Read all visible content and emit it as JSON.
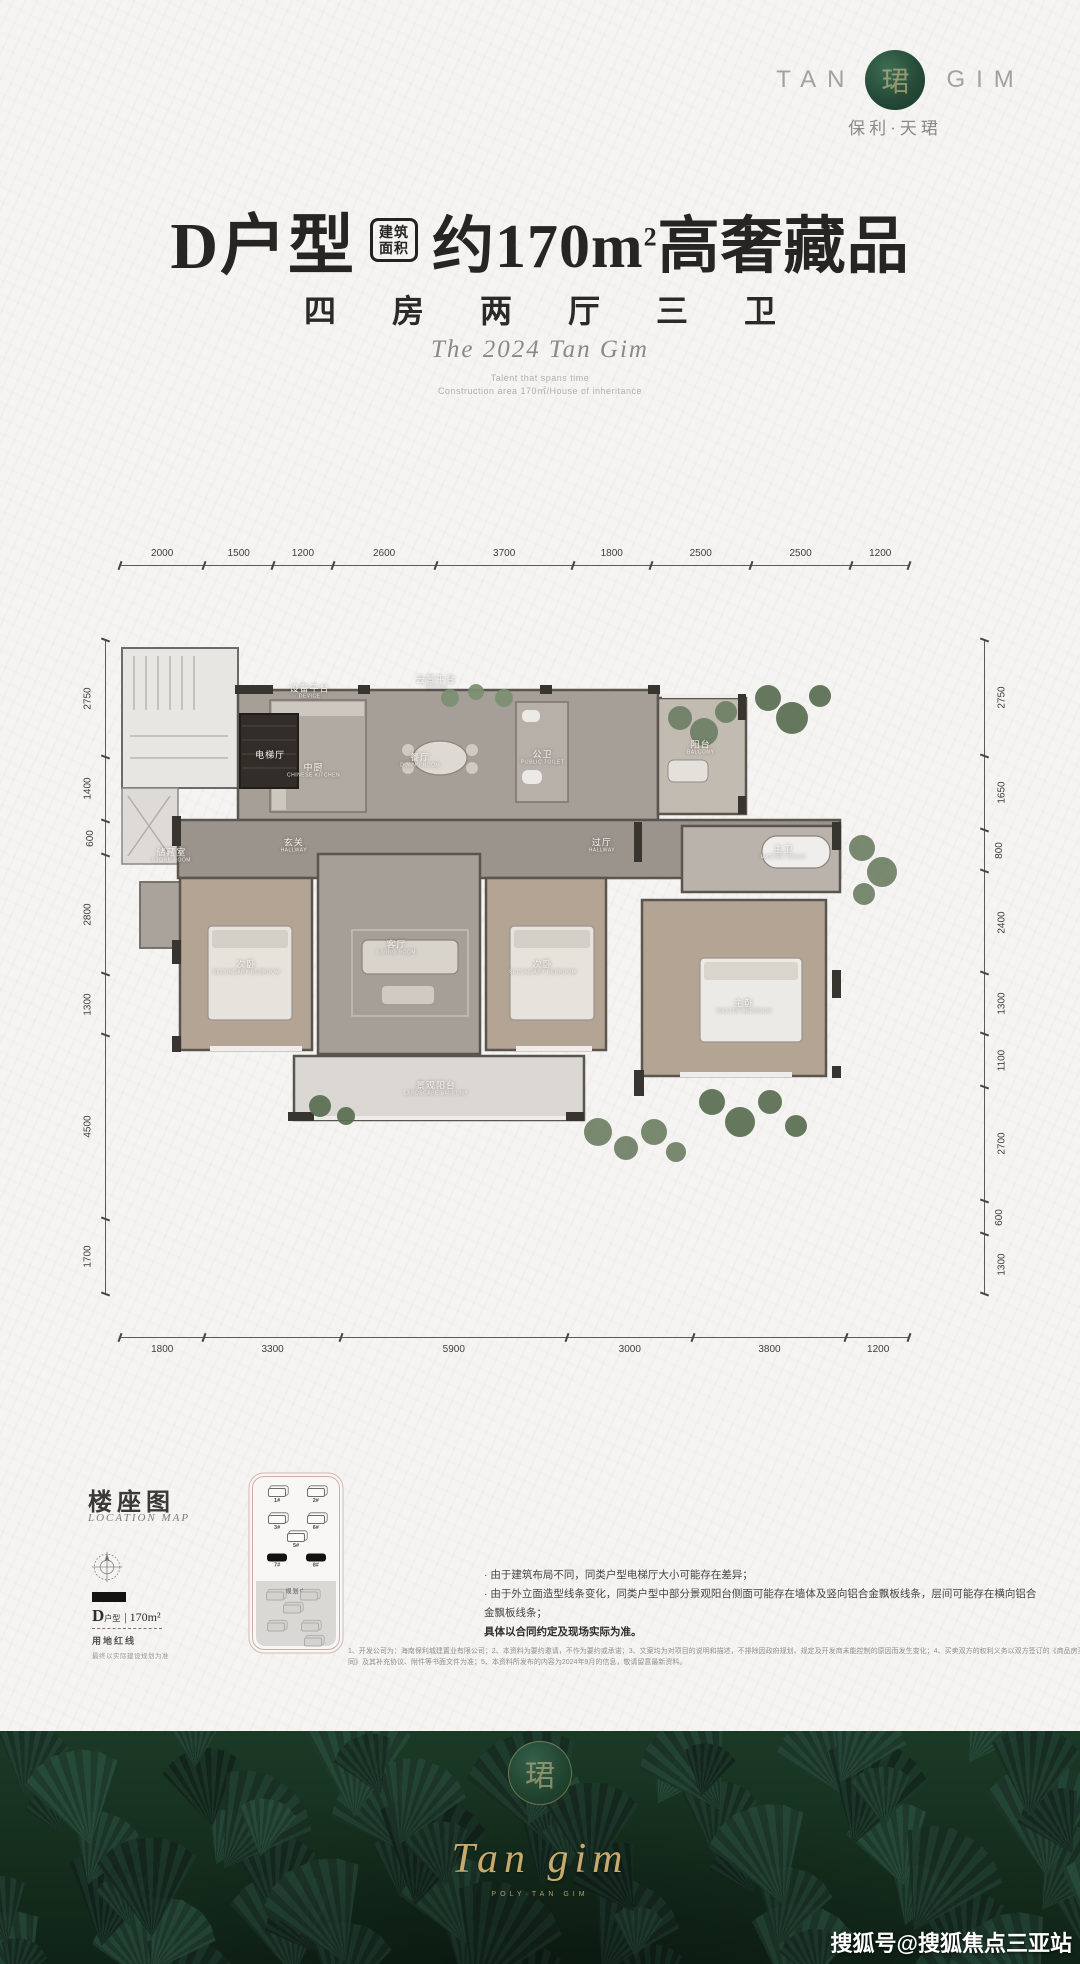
{
  "colors": {
    "accent_green": "#254b38",
    "footer_green": "#16301f",
    "gold": "#c9aa6d",
    "ink": "#262523"
  },
  "brand": {
    "wordmark_left": "TAN",
    "wordmark_right": "GIM",
    "emblem_char": "珺",
    "sub_logo": "保利·天珺"
  },
  "header": {
    "unit_name": "D户型",
    "badge_line1": "建筑",
    "badge_line2": "面积",
    "area_value": "约170m",
    "area_sup": "2",
    "area_tail": "高奢藏品",
    "subtitle": "四 房 两 厅 三 卫",
    "series_title": "The 2024 Tan Gim",
    "tagline_line1": "Talent that spans time",
    "tagline_line2": "Construction area 170㎡/House of inheritance"
  },
  "floorplan": {
    "dims_top": [
      "2000",
      "1500",
      "1200",
      "2600",
      "3700",
      "1800",
      "2500",
      "2500",
      "1200"
    ],
    "dims_bottom": [
      "1800",
      "3300",
      "5900",
      "3000",
      "3800",
      "1200"
    ],
    "dims_left": [
      "2750",
      "1400",
      "600",
      "2800",
      "1300",
      "4500",
      "1700"
    ],
    "dims_right": [
      "2750",
      "1650",
      "800",
      "2400",
      "1300",
      "1100",
      "2700",
      "600",
      "1300"
    ],
    "rooms": [
      {
        "cn": "设备平台",
        "en": "DEVICE",
        "x": 24,
        "y": 8
      },
      {
        "cn": "云景平台",
        "en": "DEVICE",
        "x": 40,
        "y": 6.5
      },
      {
        "cn": "电梯厅",
        "en": "",
        "x": 19,
        "y": 17.5
      },
      {
        "cn": "中厨",
        "en": "CHINESE KITCHEN",
        "x": 24.5,
        "y": 20
      },
      {
        "cn": "餐厅",
        "en": "DINING ROOM",
        "x": 38,
        "y": 18.5
      },
      {
        "cn": "公卫",
        "en": "PUBLIC TOILET",
        "x": 53.5,
        "y": 18
      },
      {
        "cn": "阳台",
        "en": "BALCONY",
        "x": 73.5,
        "y": 16.5
      },
      {
        "cn": "储藏室",
        "en": "STORE ROOM",
        "x": 6.5,
        "y": 33
      },
      {
        "cn": "玄关",
        "en": "HALLWAY",
        "x": 22,
        "y": 31.5
      },
      {
        "cn": "过厅",
        "en": "HALLWAY",
        "x": 61,
        "y": 31.5
      },
      {
        "cn": "主卫",
        "en": "MASTER TOILET",
        "x": 84,
        "y": 32.5
      },
      {
        "cn": "次卧",
        "en": "SECONDARY BEDROOM",
        "x": 16,
        "y": 50
      },
      {
        "cn": "客厅",
        "en": "LIVING ROOM",
        "x": 35,
        "y": 47
      },
      {
        "cn": "次卧",
        "en": "SECONDARY BEDROOM",
        "x": 53.5,
        "y": 50
      },
      {
        "cn": "主卧",
        "en": "MASTER BEDROOM",
        "x": 79,
        "y": 56
      },
      {
        "cn": "景观阳台",
        "en": "LANDSCAPE BALCONY",
        "x": 40,
        "y": 68.5
      }
    ]
  },
  "location": {
    "title": "楼座图",
    "subtitle": "LOCATION MAP",
    "legend_unit": "D",
    "legend_unit_small": "户型",
    "legend_area": "| 170m²",
    "redline_label": "用地红线",
    "note": "最终以实际建设规划为准",
    "planning_label": "规划中",
    "buildings": [
      {
        "label": "1#",
        "x": 28,
        "y": 11,
        "style": "outline"
      },
      {
        "label": "2#",
        "x": 73,
        "y": 11,
        "style": "outline"
      },
      {
        "label": "3#",
        "x": 28,
        "y": 27,
        "style": "outline"
      },
      {
        "label": "6#",
        "x": 73,
        "y": 27,
        "style": "outline"
      },
      {
        "label": "5#",
        "x": 50,
        "y": 37,
        "style": "outline"
      },
      {
        "label": "7#",
        "x": 28,
        "y": 49,
        "style": "solid"
      },
      {
        "label": "8#",
        "x": 73,
        "y": 49,
        "style": "solid"
      },
      {
        "label": "",
        "x": 25,
        "y": 69,
        "style": "faded"
      },
      {
        "label": "",
        "x": 65,
        "y": 69,
        "style": "faded"
      },
      {
        "label": "",
        "x": 45,
        "y": 77,
        "style": "faded"
      },
      {
        "label": "",
        "x": 27,
        "y": 87,
        "style": "faded"
      },
      {
        "label": "",
        "x": 66,
        "y": 87,
        "style": "faded"
      },
      {
        "label": "",
        "x": 70,
        "y": 96,
        "style": "faded"
      }
    ]
  },
  "disclaimer": {
    "bullets": [
      "由于建筑布局不同，同类户型电梯厅大小可能存在差异；",
      "由于外立面造型线条变化，同类户型中部分景观阳台侧面可能存在墙体及竖向铝合金飘板线条，层间可能存在横向铝合金飘板线条；"
    ],
    "emphasis": "具体以合同约定及现场实际为准。",
    "fine_print": [
      "1、开发公司为：海南保利城建置业有限公司；2、本资料为要约邀请，不作为要约或承诺；3、文案均为对项目的说明和描述，不排除因政府规划、规定及开发商未能控制的原因而发生变化；4、买卖双方的权利义务以双方签订的《商品房买卖合",
      "同》及其补充协议、附件等书面文件为准；5、本资料所发布的内容为2024年9月的信息，敬请留意最新资料。"
    ]
  },
  "footer": {
    "script_logo": "Tan gim",
    "script_sub": "POLY·TAN GIM",
    "watermark": "搜狐号@搜狐焦点三亚站"
  }
}
